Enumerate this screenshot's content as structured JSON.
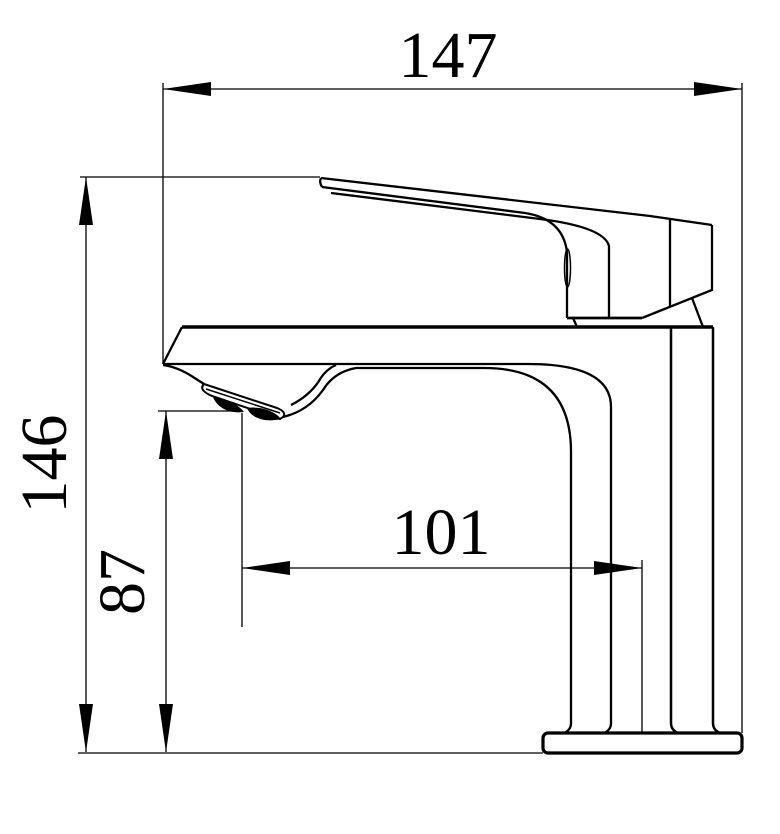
{
  "drawing": {
    "subject": "single-handle basin faucet side elevation",
    "view": "technical dimension drawing",
    "background_color": "#ffffff",
    "line_color": "#000000",
    "dimensions": [
      {
        "id": "overall-length",
        "label": "147",
        "orientation": "horizontal",
        "position": "top"
      },
      {
        "id": "overall-height",
        "label": "146",
        "orientation": "vertical",
        "position": "far-left"
      },
      {
        "id": "outlet-height",
        "label": "87",
        "orientation": "vertical",
        "position": "left-inner"
      },
      {
        "id": "outlet-reach",
        "label": "101",
        "orientation": "horizontal",
        "position": "middle"
      }
    ]
  }
}
